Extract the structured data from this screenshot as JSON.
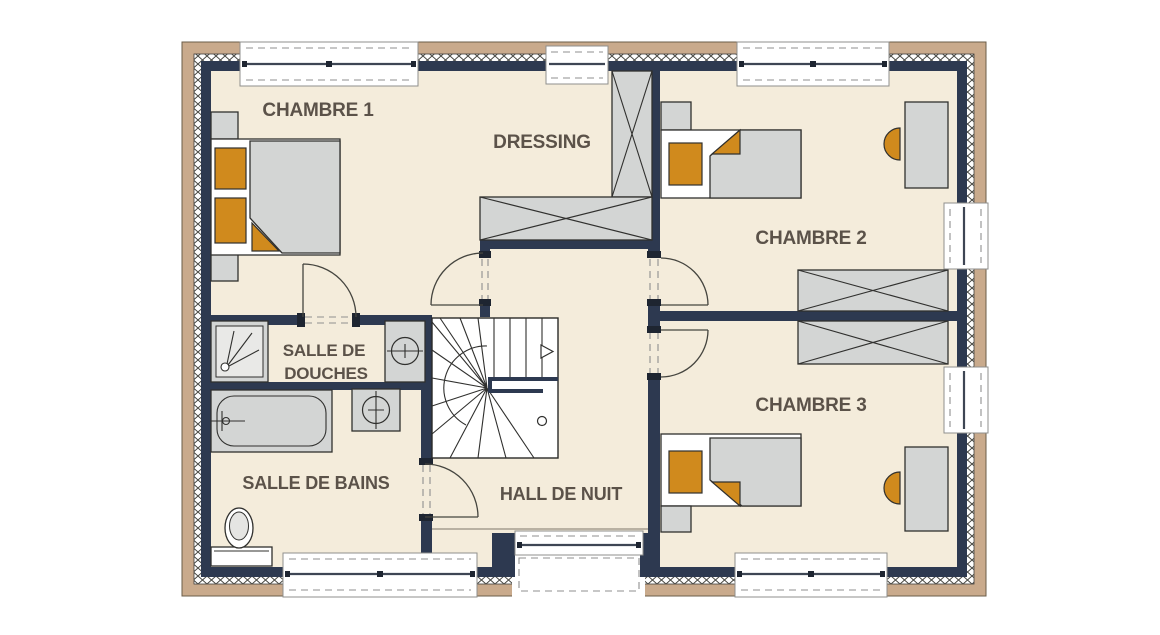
{
  "title": "Floor plan — first floor",
  "labels": {
    "chambre1": "CHAMBRE 1",
    "dressing": "DRESSING",
    "chambre2": "CHAMBRE 2",
    "douches1": "SALLE DE",
    "douches2": "DOUCHES",
    "bains": "SALLE DE BAINS",
    "hall": "HALL DE NUIT",
    "chambre3": "CHAMBRE 3"
  },
  "fixtures": [
    "double-bed",
    "single-bed",
    "single-bed",
    "nightstand",
    "nightstand",
    "nightstand",
    "nightstand",
    "wardrobe-vertical",
    "wardrobe-horizontal",
    "wardrobe-chambre2",
    "wardrobe-chambre3",
    "desk",
    "desk",
    "chair",
    "chair",
    "shower",
    "washbasin",
    "washbasin",
    "bathtub",
    "toilet",
    "winder-staircase",
    "stair-direction-arrow",
    "window-top-chambre1",
    "window-top-dressing",
    "window-top-chambre2",
    "window-right-chambre2",
    "window-right-chambre3",
    "window-bottom-chambre3",
    "window-bottom-hall",
    "window-bottom-bains",
    "door-chambre1",
    "door-dressing",
    "door-chambre2",
    "door-chambre3",
    "door-bains"
  ],
  "colors": {
    "floor": "#f4ecdb",
    "wall": "#2d3950",
    "brick": "#c9aa8c",
    "furniture": "#d3d5d4",
    "accent": "#d08a1d",
    "outline": "#30302e",
    "label": "#5b5249",
    "threshold": "#a59d8f"
  }
}
